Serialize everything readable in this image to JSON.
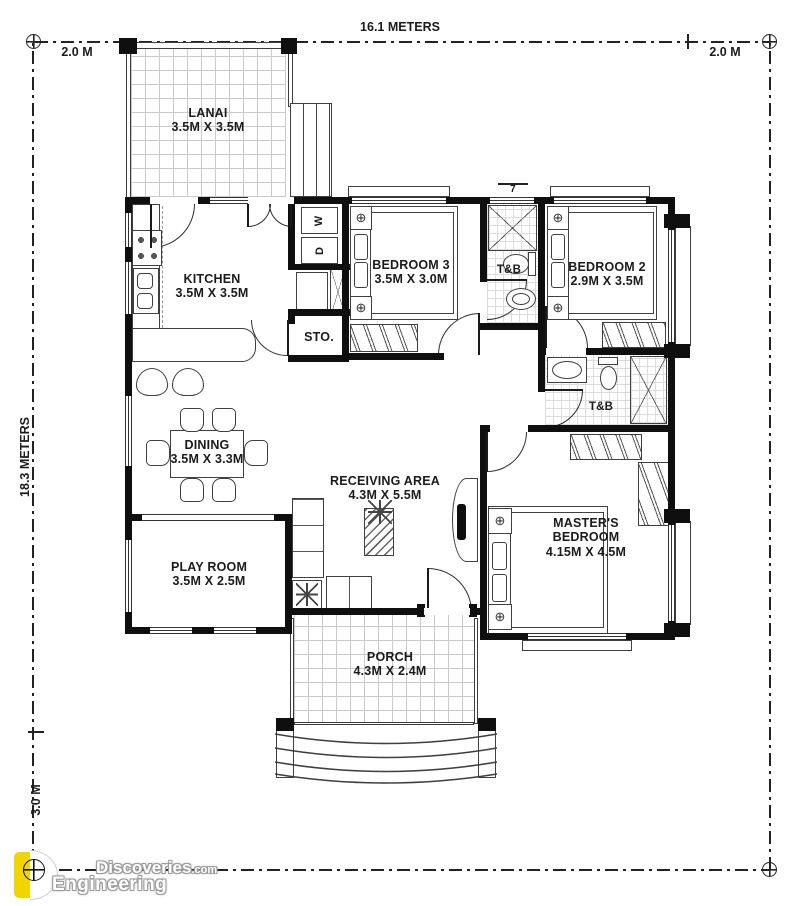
{
  "dimensions": {
    "top_width": "16.1 METERS",
    "left_setback": "2.0 M",
    "right_setback": "2.0 M",
    "side_depth": "18.3 METERS",
    "bottom_setback": "3.0 M"
  },
  "rooms": {
    "lanai": {
      "name": "LANAI",
      "size": "3.5M X 3.5M"
    },
    "kitchen": {
      "name": "KITCHEN",
      "size": "3.5M X 3.5M"
    },
    "storage": {
      "name": "STO."
    },
    "bedroom3": {
      "name": "BEDROOM 3",
      "size": "3.5M X 3.0M"
    },
    "toilet_bath_1": {
      "name": "T&B"
    },
    "bedroom2": {
      "name": "BEDROOM 2",
      "size": "2.9M X 3.5M"
    },
    "dining": {
      "name": "DINING",
      "size": "3.5M X 3.3M"
    },
    "receiving": {
      "name": "RECEIVING AREA",
      "size": "4.3M X 5.5M"
    },
    "toilet_bath_2": {
      "name": "T&B"
    },
    "master_bedroom": {
      "name": "MASTER'S BEDROOM",
      "size": "4.15M X 4.5M"
    },
    "playroom": {
      "name": "PLAY ROOM",
      "size": "3.5M X 2.5M"
    },
    "porch": {
      "name": "PORCH",
      "size": "4.3M X 2.4M"
    }
  },
  "appliances": {
    "washer": "W",
    "dryer": "D"
  },
  "annotations": {
    "window_tag": "7"
  },
  "symbols": {
    "corner_fixture": "⊕"
  },
  "watermark": {
    "line_top": "Discoveries",
    "line_top_suffix": ".com",
    "line_bottom": "Engineering"
  },
  "colors": {
    "wall": "#0f0f0f",
    "line": "#3f3f3f",
    "tile_line": "#c9c9c9",
    "logo_yellow": "#f2d400"
  }
}
